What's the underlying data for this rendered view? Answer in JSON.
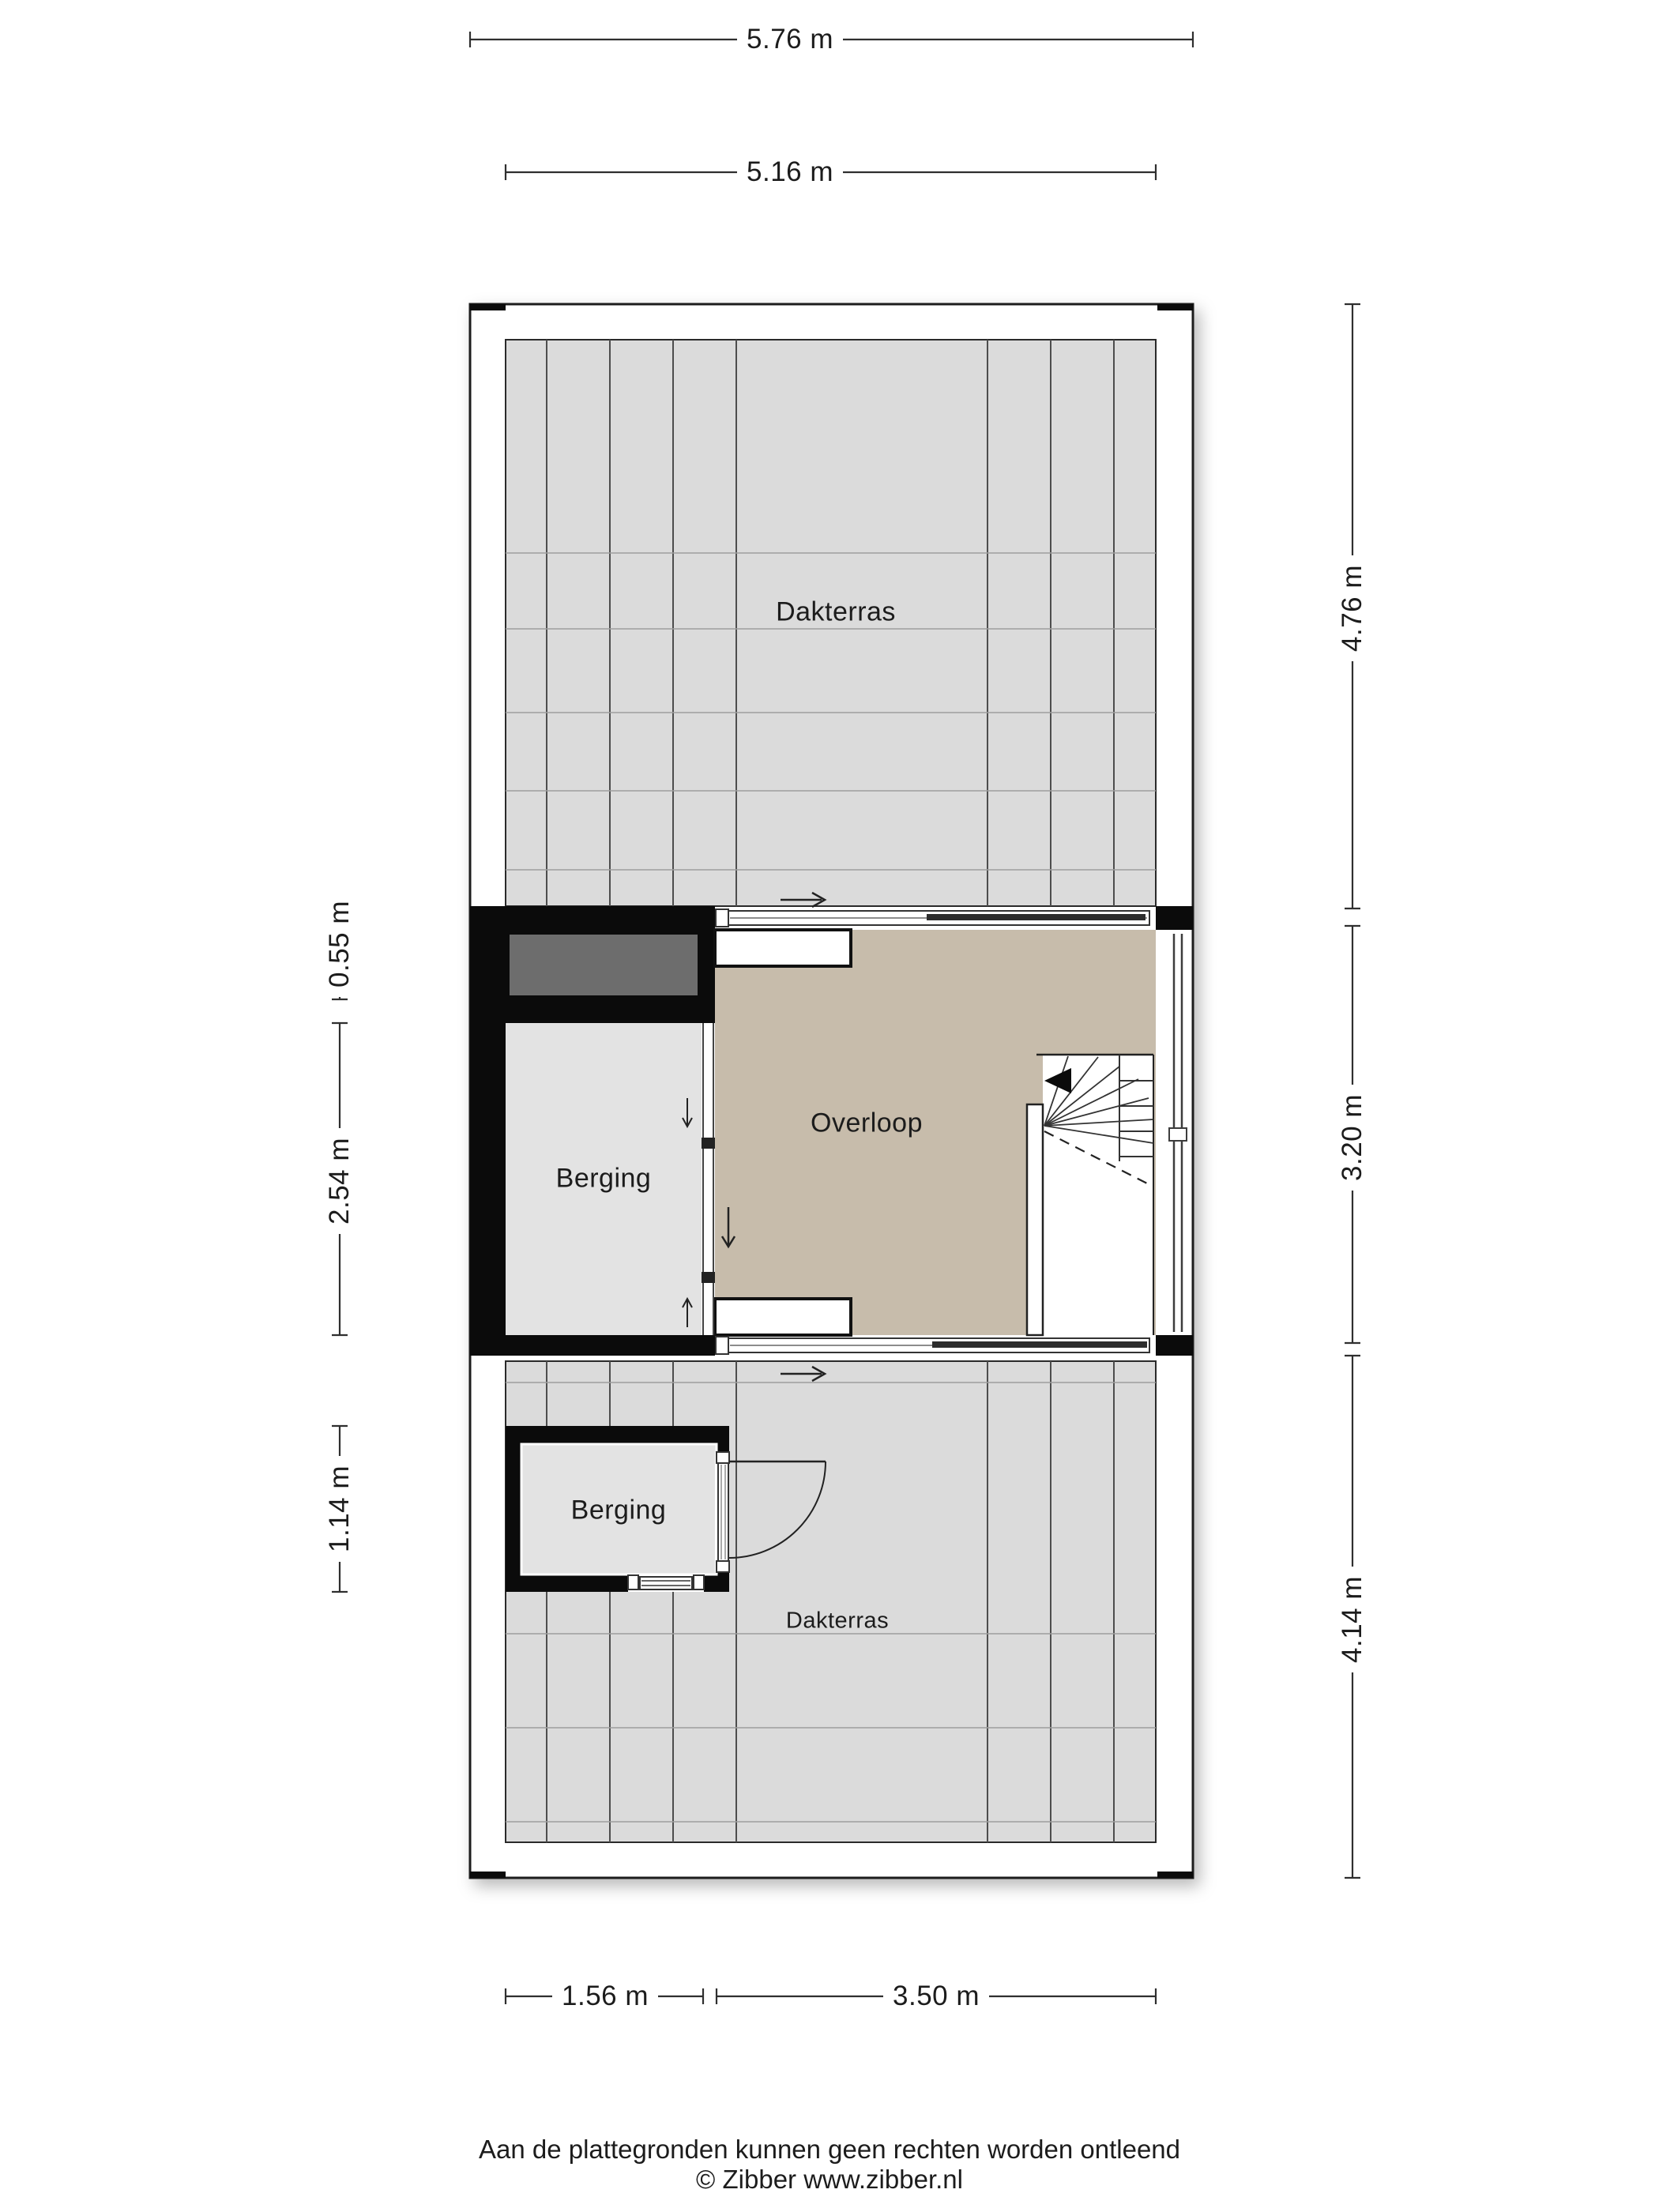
{
  "title": "Plattegrond verdieping",
  "rooms": {
    "dakterras_top": "Dakterras",
    "overloop": "Overloop",
    "berging_middle": "Berging",
    "berging_lower": "Berging",
    "dakterras_bottom": "Dakterras"
  },
  "dimensions": {
    "top_outer": "5.76 m",
    "top_inner": "5.16 m",
    "right_top": "4.76 m",
    "right_middle": "3.20 m",
    "right_bottom": "4.14 m",
    "left_top": "0.55 m",
    "left_middle": "2.54 m",
    "left_bottom": "1.14 m",
    "bottom_left": "1.56 m",
    "bottom_right": "3.50 m"
  },
  "footer": {
    "disclaimer": "Aan de plattegronden kunnen geen rechten worden ontleend",
    "credit": "© Zibber www.zibber.nl"
  },
  "colors": {
    "wall": "#0b0b0b",
    "tile": "#dbdbdb",
    "tile-line-v": "#4d4d4d",
    "tile-line-h": "#9e9e9e",
    "overloop-floor": "#c7bcab",
    "room-fill": "#e3e3e3",
    "niche-fill": "#6d6d6d",
    "dim-line": "#2f2f2f",
    "outline": "#1a1a1a",
    "text": "#1c1c1c"
  }
}
